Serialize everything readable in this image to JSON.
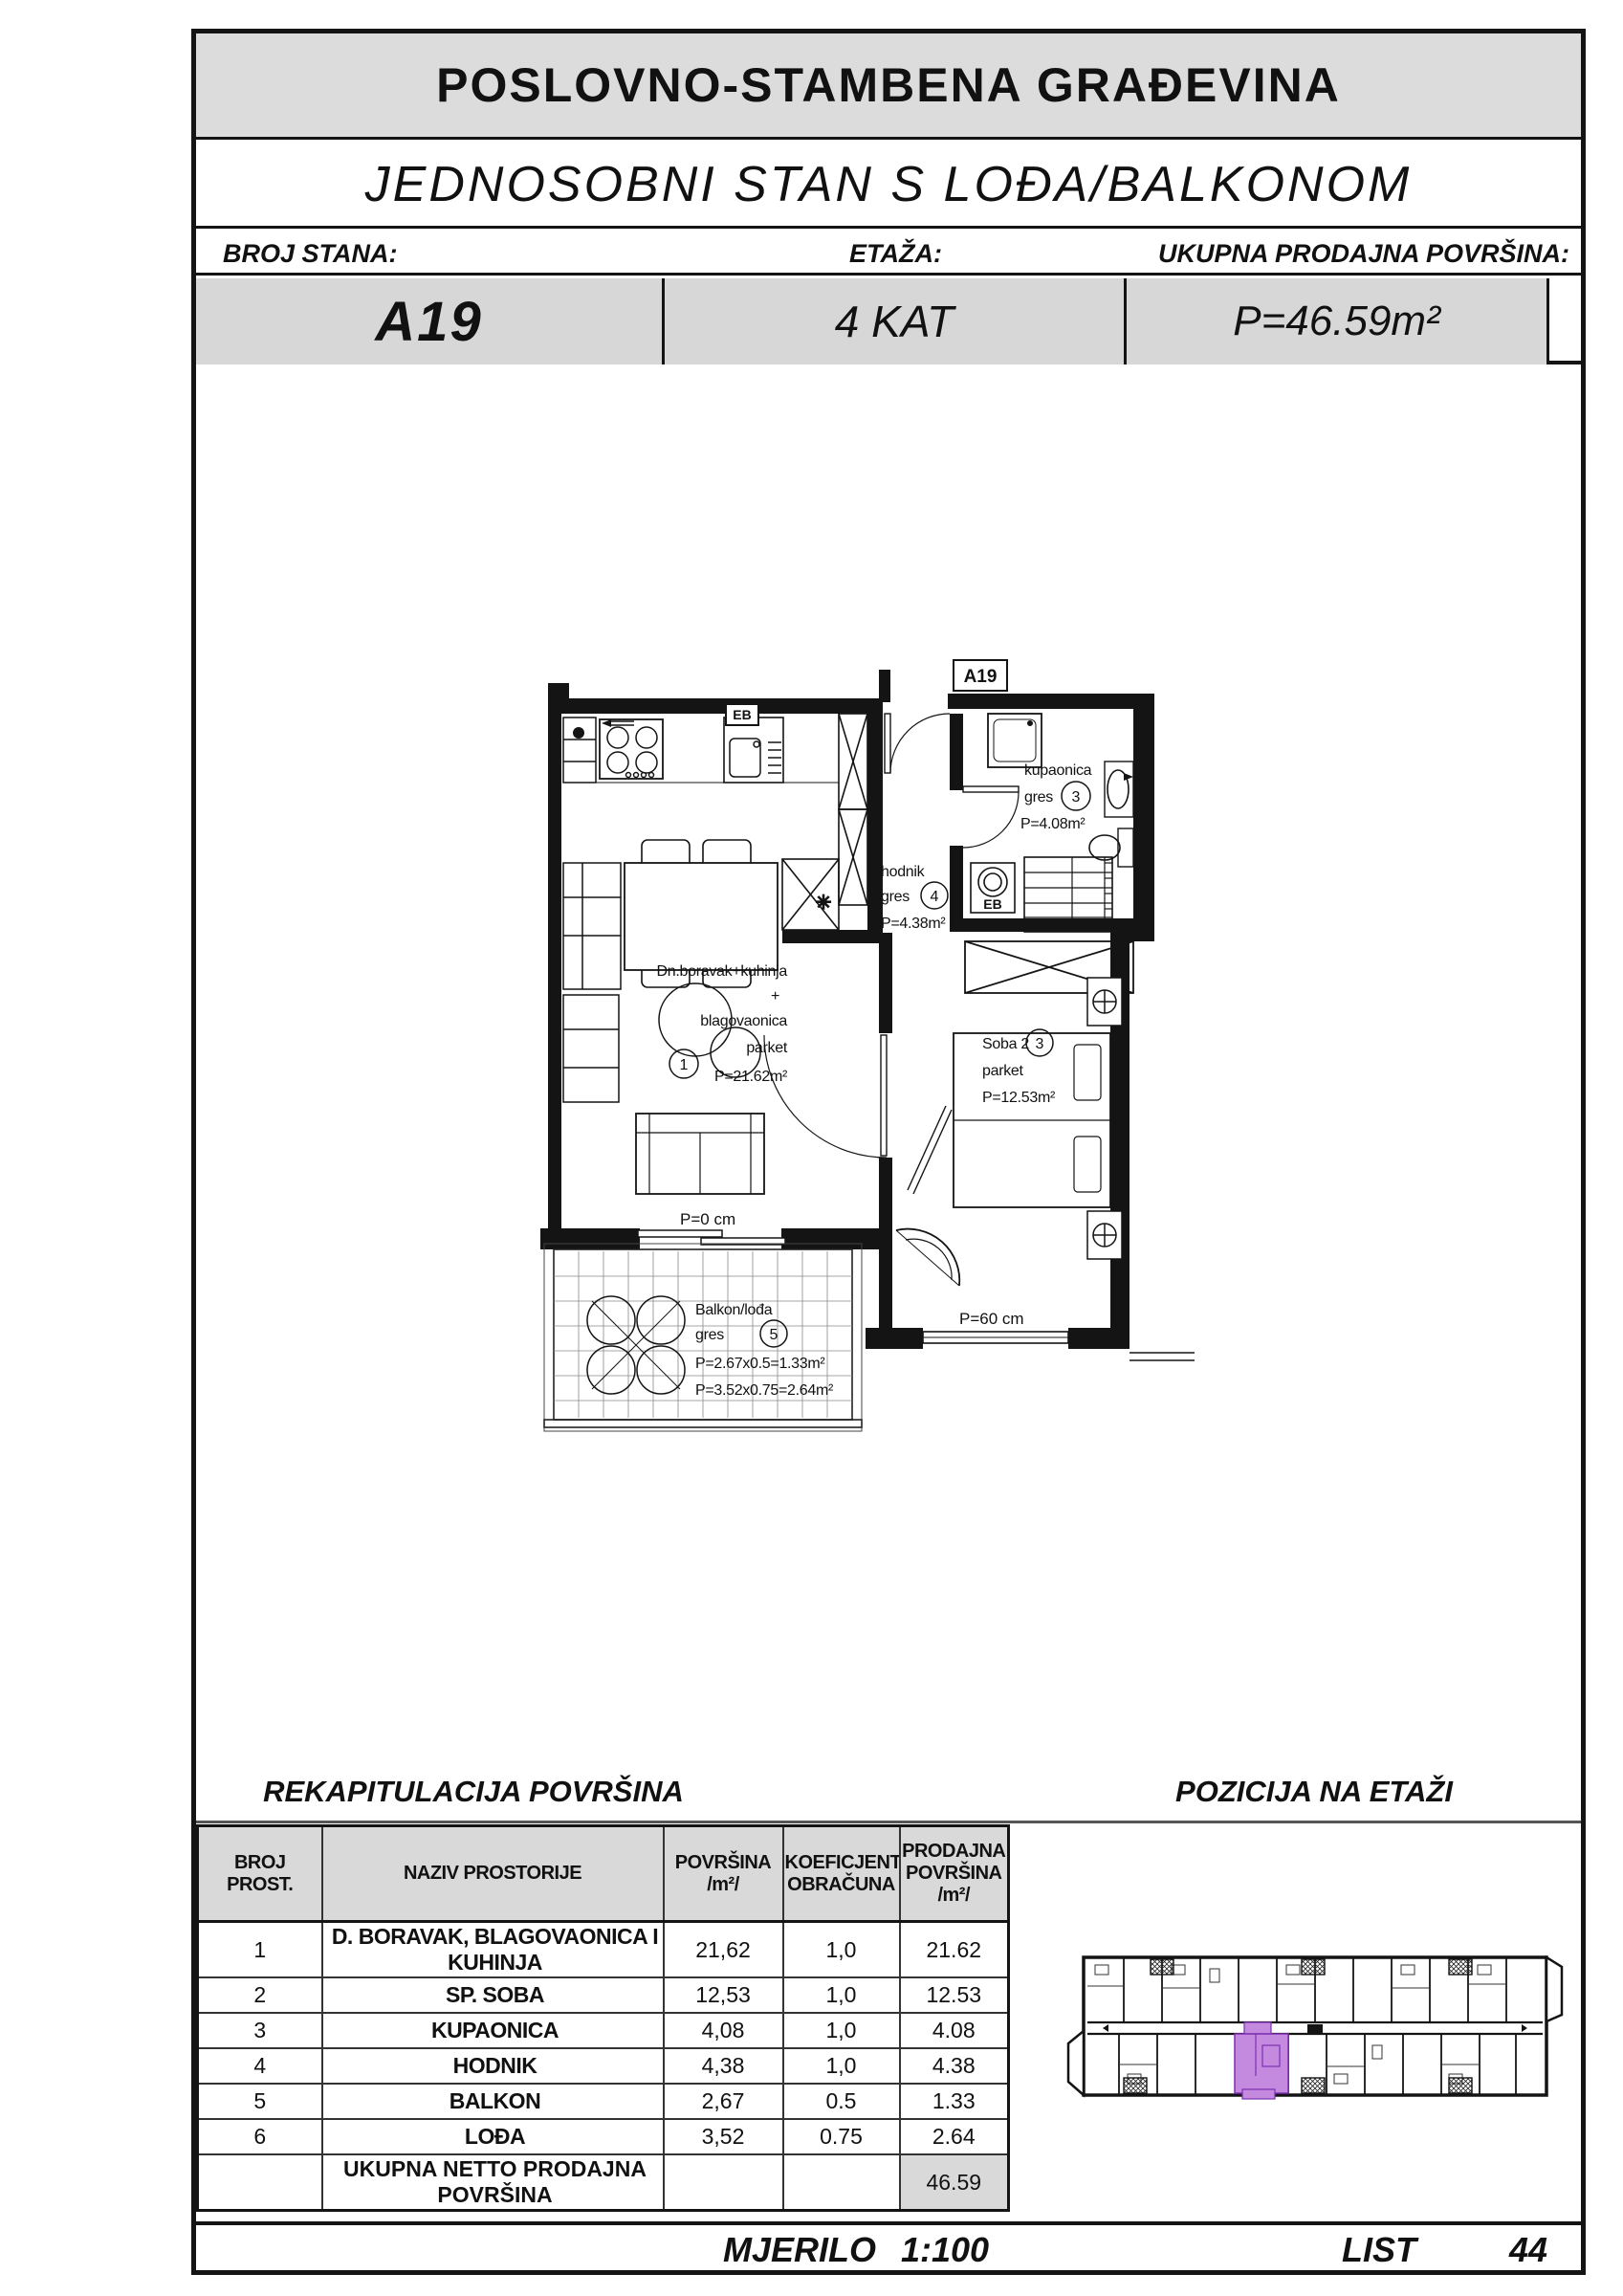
{
  "header": {
    "building_title": "POSLOVNO-STAMBENA GRAĐEVINA",
    "apartment_title": "JEDNOSOBNI STAN S LOĐA/BALKONOM",
    "broj_stana_label": "BROJ STANA:",
    "broj_stana_value": "A19",
    "etaza_label": "ETAŽA:",
    "etaza_value": "4 KAT",
    "povrsina_label": "UKUPNA PRODAJNA POVRŠINA:",
    "povrsina_value": "P=46.59m²"
  },
  "plan": {
    "unit_tag": "A19",
    "living": {
      "num": "1",
      "line1": "Dn.boravak+kuhinja",
      "line2": "+",
      "line3": "blagovaonica",
      "line4": "parket",
      "line5": "P=21.62m²"
    },
    "hodnik": {
      "num": "4",
      "line1": "hodnik",
      "line2": "gres",
      "line3": "P=4.38m²"
    },
    "kupaonica": {
      "num": "3",
      "line1": "kupaonica",
      "line2": "gres",
      "line3": "P=4.08m²"
    },
    "soba": {
      "num": "3",
      "line1": "Soba 2",
      "line2": "parket",
      "line3": "P=12.53m²"
    },
    "balkon": {
      "num": "5",
      "line1": "Balkon/lođa",
      "line2": "gres",
      "line3": "P=2.67x0.5=1.33m²",
      "line4": "P=3.52x0.75=2.64m²"
    },
    "dim_zero": "P=0 cm",
    "dim_sixty": "P=60 cm",
    "eb_kitchen": "EB",
    "eb_bath": "EB"
  },
  "recap": {
    "title": "REKAPITULACIJA POVRŠINA",
    "columns": [
      "BROJ PROST.",
      "NAZIV PROSTORIJE",
      "POVRŠINA /m²/",
      "KOEFICJENT OBRAČUNA",
      "PRODAJNA POVRŠINA /m²/"
    ],
    "rows": [
      {
        "num": "1",
        "name": "D. BORAVAK, BLAGOVAONICA I KUHINJA",
        "area": "21,62",
        "koef": "1,0",
        "prodajna": "21.62"
      },
      {
        "num": "2",
        "name": "SP. SOBA",
        "area": "12,53",
        "koef": "1,0",
        "prodajna": "12.53"
      },
      {
        "num": "3",
        "name": "KUPAONICA",
        "area": "4,08",
        "koef": "1,0",
        "prodajna": "4.08"
      },
      {
        "num": "4",
        "name": "HODNIK",
        "area": "4,38",
        "koef": "1,0",
        "prodajna": "4.38"
      },
      {
        "num": "5",
        "name": "BALKON",
        "area": "2,67",
        "koef": "0.5",
        "prodajna": "1.33"
      },
      {
        "num": "6",
        "name": "LOĐA",
        "area": "3,52",
        "koef": "0.75",
        "prodajna": "2.64"
      }
    ],
    "total_label": "UKUPNA NETTO PRODAJNA POVRŠINA",
    "total_value": "46.59"
  },
  "pozicija_title": "POZICIJA NA ETAŽI",
  "footer": {
    "mjerilo_label": "MJERILO",
    "mjerilo_value": "1:100",
    "list_label": "LIST",
    "list_value": "44"
  },
  "colors": {
    "accent_unit": "#c48ae0",
    "accent_unit_stroke": "#7d2fae",
    "band_gray": "#d7d7d7"
  }
}
